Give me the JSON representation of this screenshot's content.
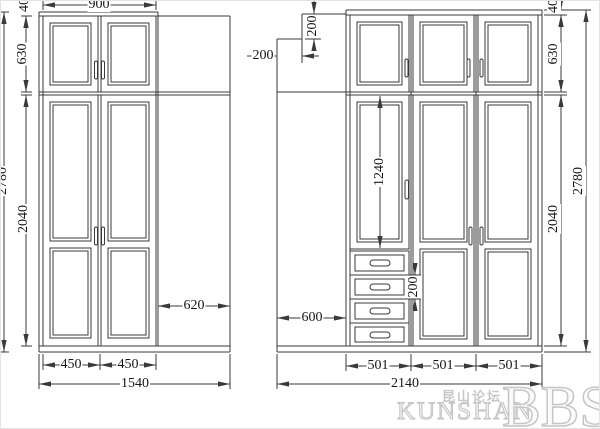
{
  "drawing": {
    "type": "wardrobe-elevation-cad-drawing",
    "views": [
      "left-wardrobe-elevation",
      "right-wardrobe-elevation"
    ]
  },
  "dims": {
    "l_top_width": "900",
    "l_top_panel": "40",
    "l_upper_h": "630",
    "l_lower_h": "2040",
    "l_total_h": "2780",
    "l_side_w": "620",
    "l_door1_w": "450",
    "l_door2_w": "450",
    "l_total_w": "1540",
    "r_notch_h": "200",
    "r_notch_w": "200",
    "r_tall_door_h": "1240",
    "r_drawer_h": "200",
    "r_open_w": "600",
    "r_top_panel": "40",
    "r_upper_h": "630",
    "r_lower_h": "2040",
    "r_total_h": "2780",
    "r_col1_w": "501",
    "r_col2_w": "501",
    "r_col3_w": "501",
    "r_total_w": "2140"
  },
  "watermark": {
    "site_cn": "昆山论坛",
    "site_latin": "KUNSHAN",
    "site_suffix": "BBS"
  }
}
